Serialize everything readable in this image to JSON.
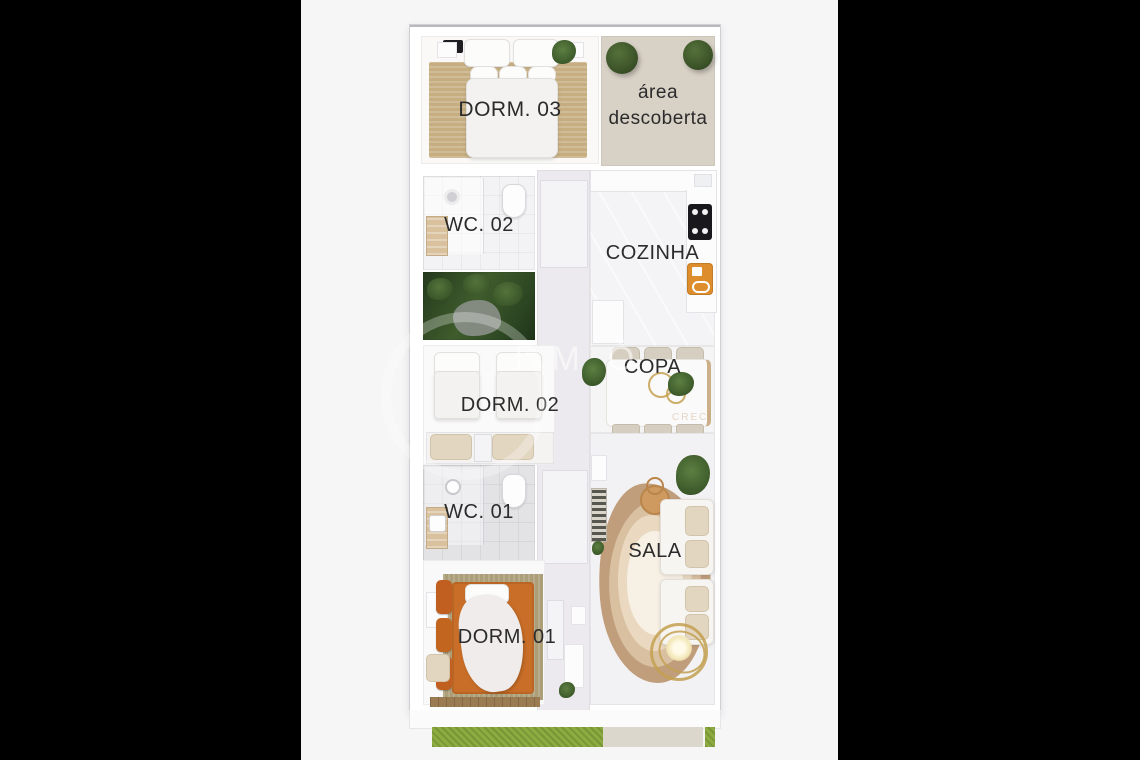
{
  "image": {
    "type": "apartment floor plan render",
    "background": "#000000",
    "card_background": "#f6f6f7"
  },
  "rooms": {
    "dorm03": {
      "label": "DORM. 03"
    },
    "area_descoberta": {
      "line1": "área",
      "line2": "descoberta"
    },
    "wc02": {
      "label": "WC. 02"
    },
    "cozinha": {
      "label": "COZINHA"
    },
    "dorm02": {
      "label": "DORM. 02"
    },
    "copa": {
      "label": "COPA"
    },
    "wc01": {
      "label": "WC. 01"
    },
    "sala": {
      "label": "SALA"
    },
    "dorm01": {
      "label": "DORM. 01"
    }
  },
  "watermark": {
    "text": "IMÓ",
    "subtext": "CRECI"
  },
  "colors": {
    "label_text": "#2b2b2b",
    "rug_tan": "#c6ae81",
    "area_floor": "#d8d1c6",
    "garden_green": "#3f5c2c",
    "tree_green": "#3d5429",
    "terracotta_bed": "#c96e28",
    "orange_appliance": "#dd8d2c",
    "cooktop_black": "#19191d",
    "grass_green": "#8cab41",
    "sala_rug_outer": "#c09e7c"
  }
}
